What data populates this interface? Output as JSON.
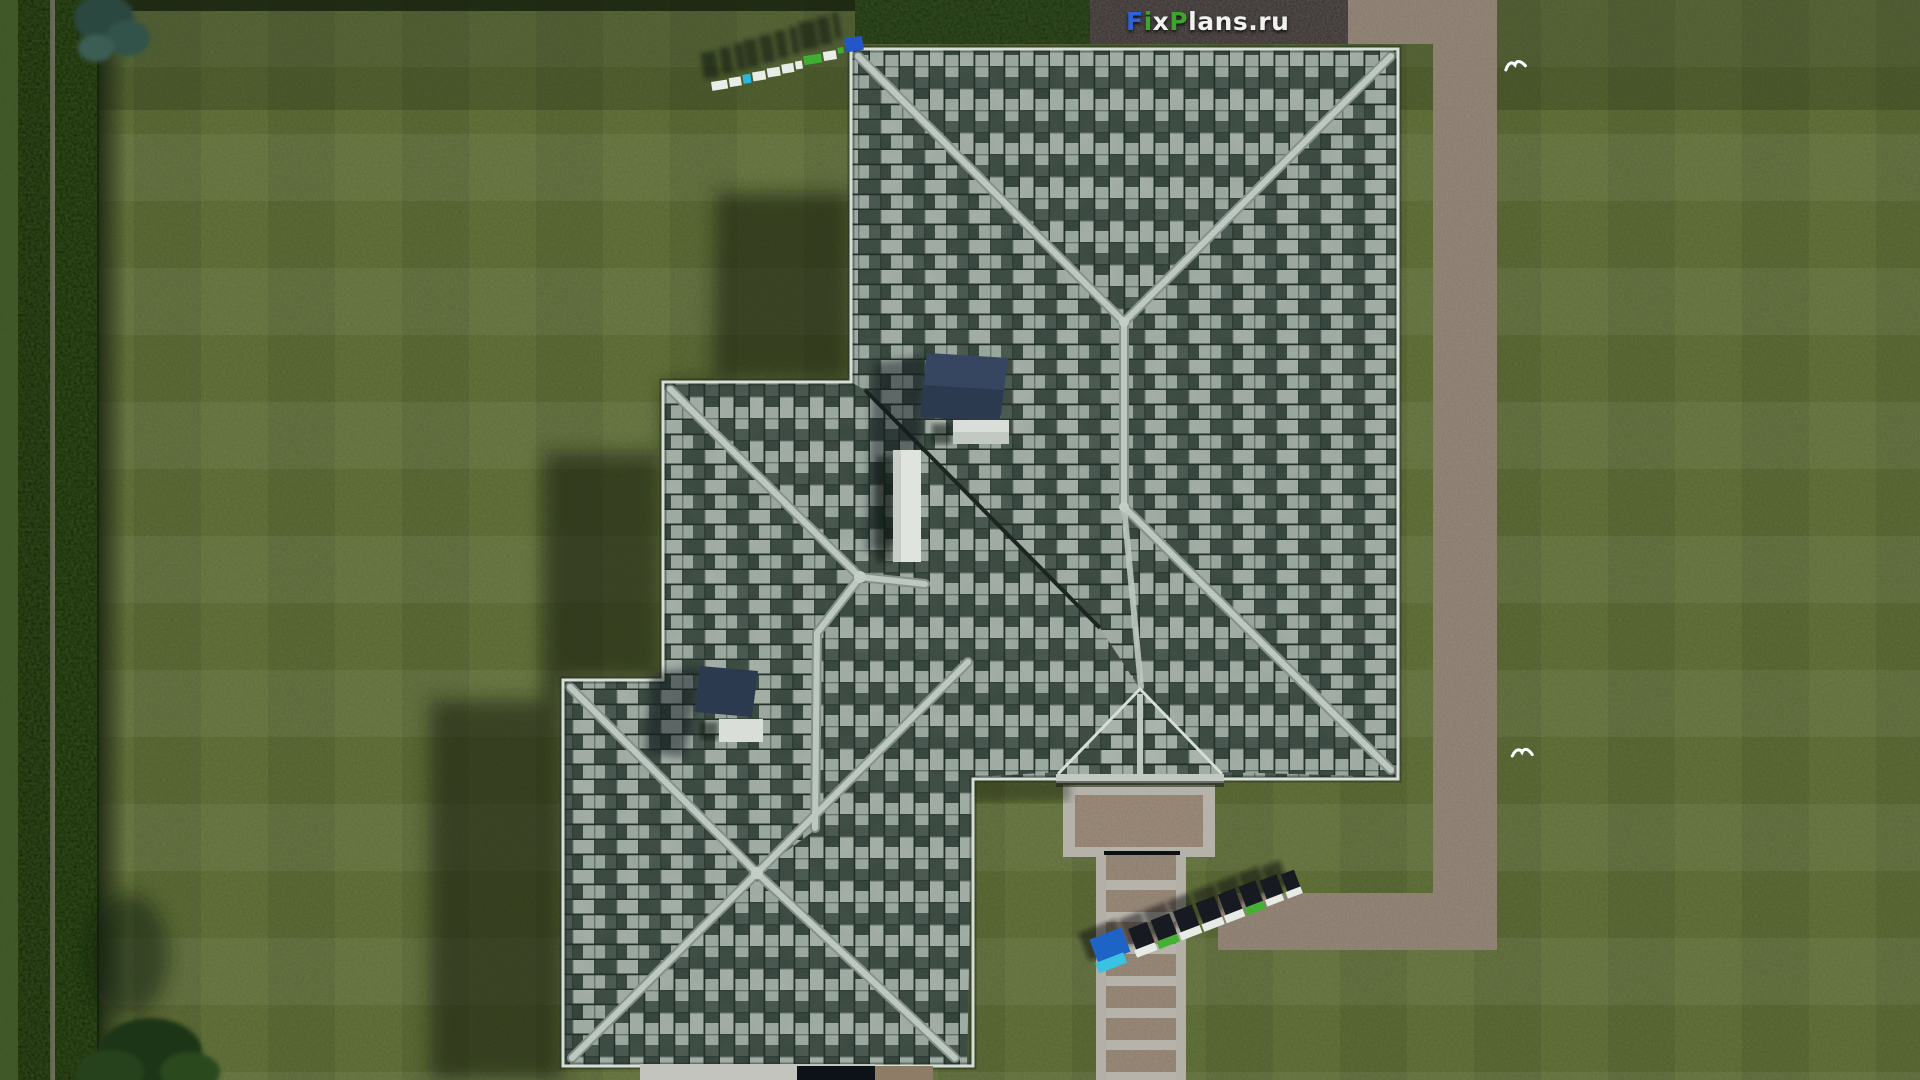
{
  "watermark": {
    "full_text": "FixPlans.ru",
    "background": "#2a2c30",
    "segments": [
      {
        "text": "F",
        "color": "#2e62d9"
      },
      {
        "text": "i",
        "color": "#3da52e"
      },
      {
        "text": "x",
        "color": "#f1f2f0"
      },
      {
        "text": "P",
        "color": "#3da52e"
      },
      {
        "text": "lans.ru",
        "color": "#f1f2f0"
      }
    ]
  },
  "ground_marks": {
    "top_roof_corner": {
      "text": "FixPlans.ru"
    },
    "walkway": {
      "text": "FixPlans.ru"
    }
  },
  "scene": {
    "view": "aerial-top-down-render",
    "subject": "hip-roof-house-with-lawn-and-gravel-paths",
    "colors": {
      "grass_base": "#66753e",
      "grass_light": "#71804a",
      "grass_dark": "#55683a",
      "hedge_dark": "#131e0c",
      "fence_line": "#6f715f",
      "path_gravel": "#97897a",
      "concrete": "#b5b2aa",
      "tile_light": "#d4dfd7",
      "tile_dark": "#3e4d45",
      "ridge_cap": "#bcc8c0",
      "valley": "#1c2620",
      "skylight": "#2c3a50",
      "chimney": "#d9ded8",
      "shadow": "#121d0a",
      "bird": "#ffffff"
    },
    "elements": [
      "striped-lawn",
      "left-hedge-row",
      "tree-canopy-top-left",
      "bush-bottom-left",
      "gravel-path-right",
      "gravel-path-bottom",
      "entry-landing",
      "walkway-steps",
      "main-hip-roof",
      "west-wing-roof",
      "south-west-annex-roof",
      "porch-roof",
      "skylight-upper",
      "skylight-lower",
      "chimney-wide",
      "chimney-tall",
      "chimney-small",
      "3d-watermark-top",
      "3d-watermark-walkway",
      "white-bird-top",
      "white-bird-middle",
      "entry-door",
      "site-logo-watermark"
    ]
  }
}
